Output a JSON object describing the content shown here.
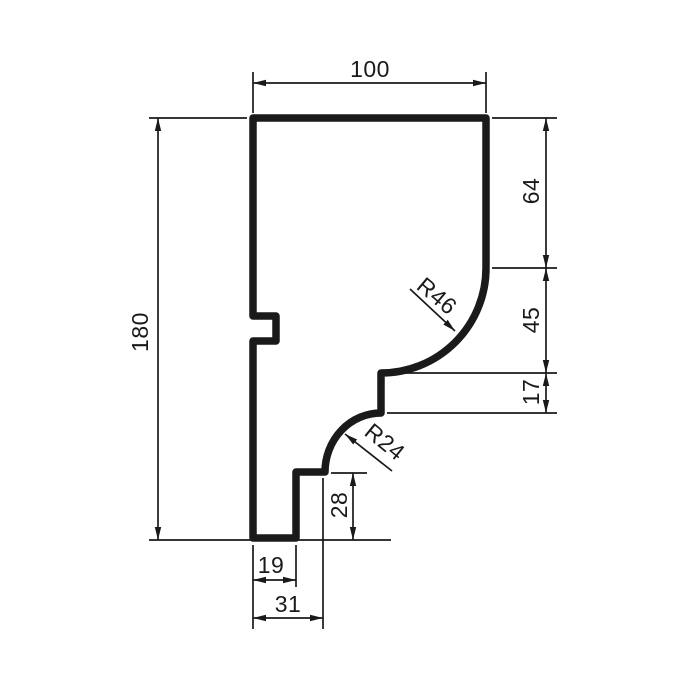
{
  "labels": {
    "top_width": "100",
    "overall_height": "180",
    "right_upper_height": "64",
    "cove_height": "45",
    "fillet_height": "17",
    "step_height": "28",
    "step_width": "19",
    "base_width": "31",
    "radius_large": "R46",
    "radius_small": "R24"
  },
  "colors": {
    "ink": "#1a1a1a",
    "background": "#ffffff"
  }
}
